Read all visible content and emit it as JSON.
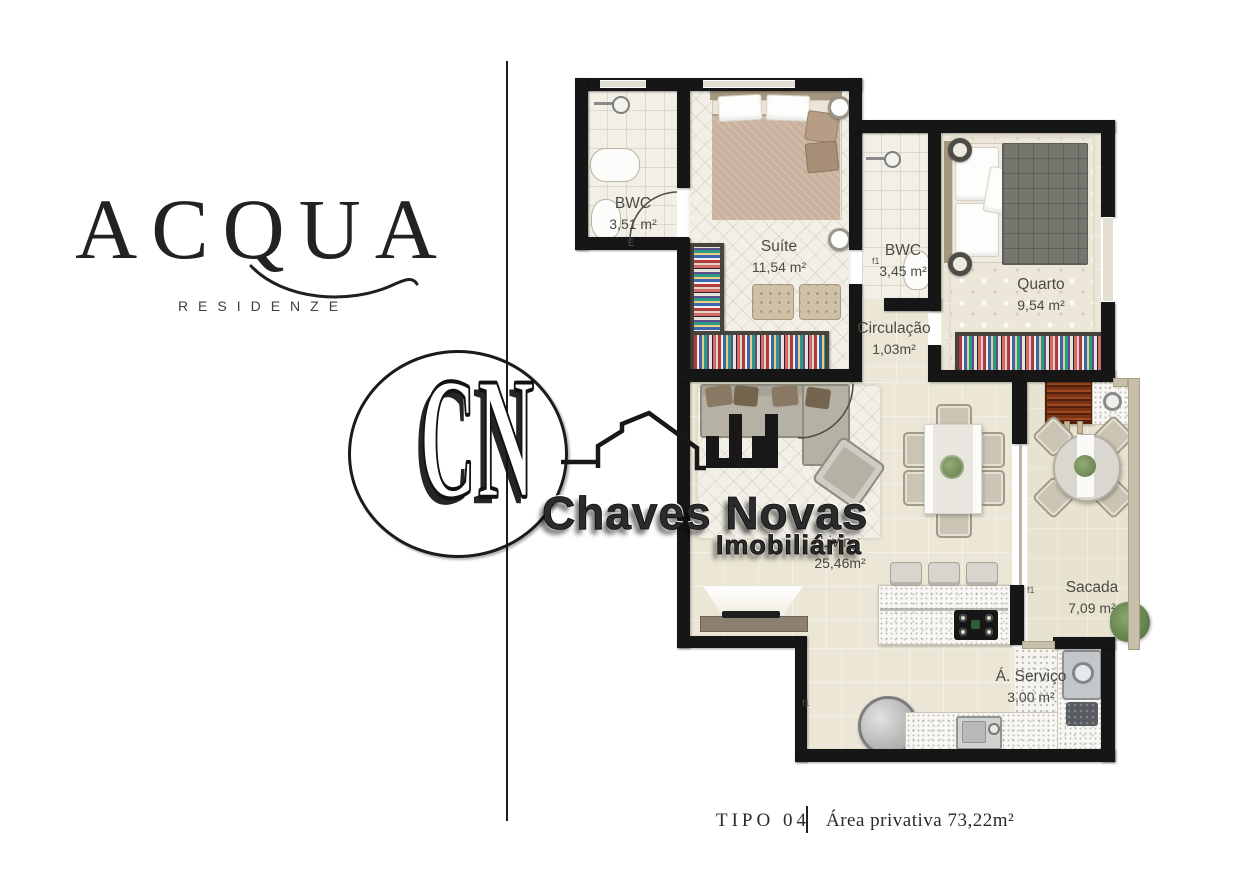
{
  "brand": {
    "name": "ACQUA",
    "subtitle": "RESIDENZE"
  },
  "watermark": {
    "initials": "CN",
    "company": "Chaves Novas",
    "tagline": "Imobiliária"
  },
  "plan": {
    "rooms": [
      {
        "name": "BWC",
        "area": "3,51 m²"
      },
      {
        "name": "Suíte",
        "area": "11,54 m²"
      },
      {
        "name": "BWC",
        "area": "3,45 m²"
      },
      {
        "name": "Quarto",
        "area": "9,54 m²"
      },
      {
        "name": "Circulação",
        "area": "1,03m²"
      },
      {
        "name": "Living",
        "area": "25,46m²"
      },
      {
        "name": "Sacada",
        "area": "7,09 m²"
      },
      {
        "name": "Á. Serviço",
        "area": "3,00 m²"
      }
    ],
    "tags": [
      "E",
      "f1",
      "f1",
      "f1"
    ]
  },
  "caption": {
    "type": "TIPO 04",
    "area": "Área privativa 73,22m²"
  },
  "colors": {
    "wall": "#161616",
    "floor": "#ebe6d5",
    "wood": "#8b8070",
    "brick": "#7c3315"
  }
}
